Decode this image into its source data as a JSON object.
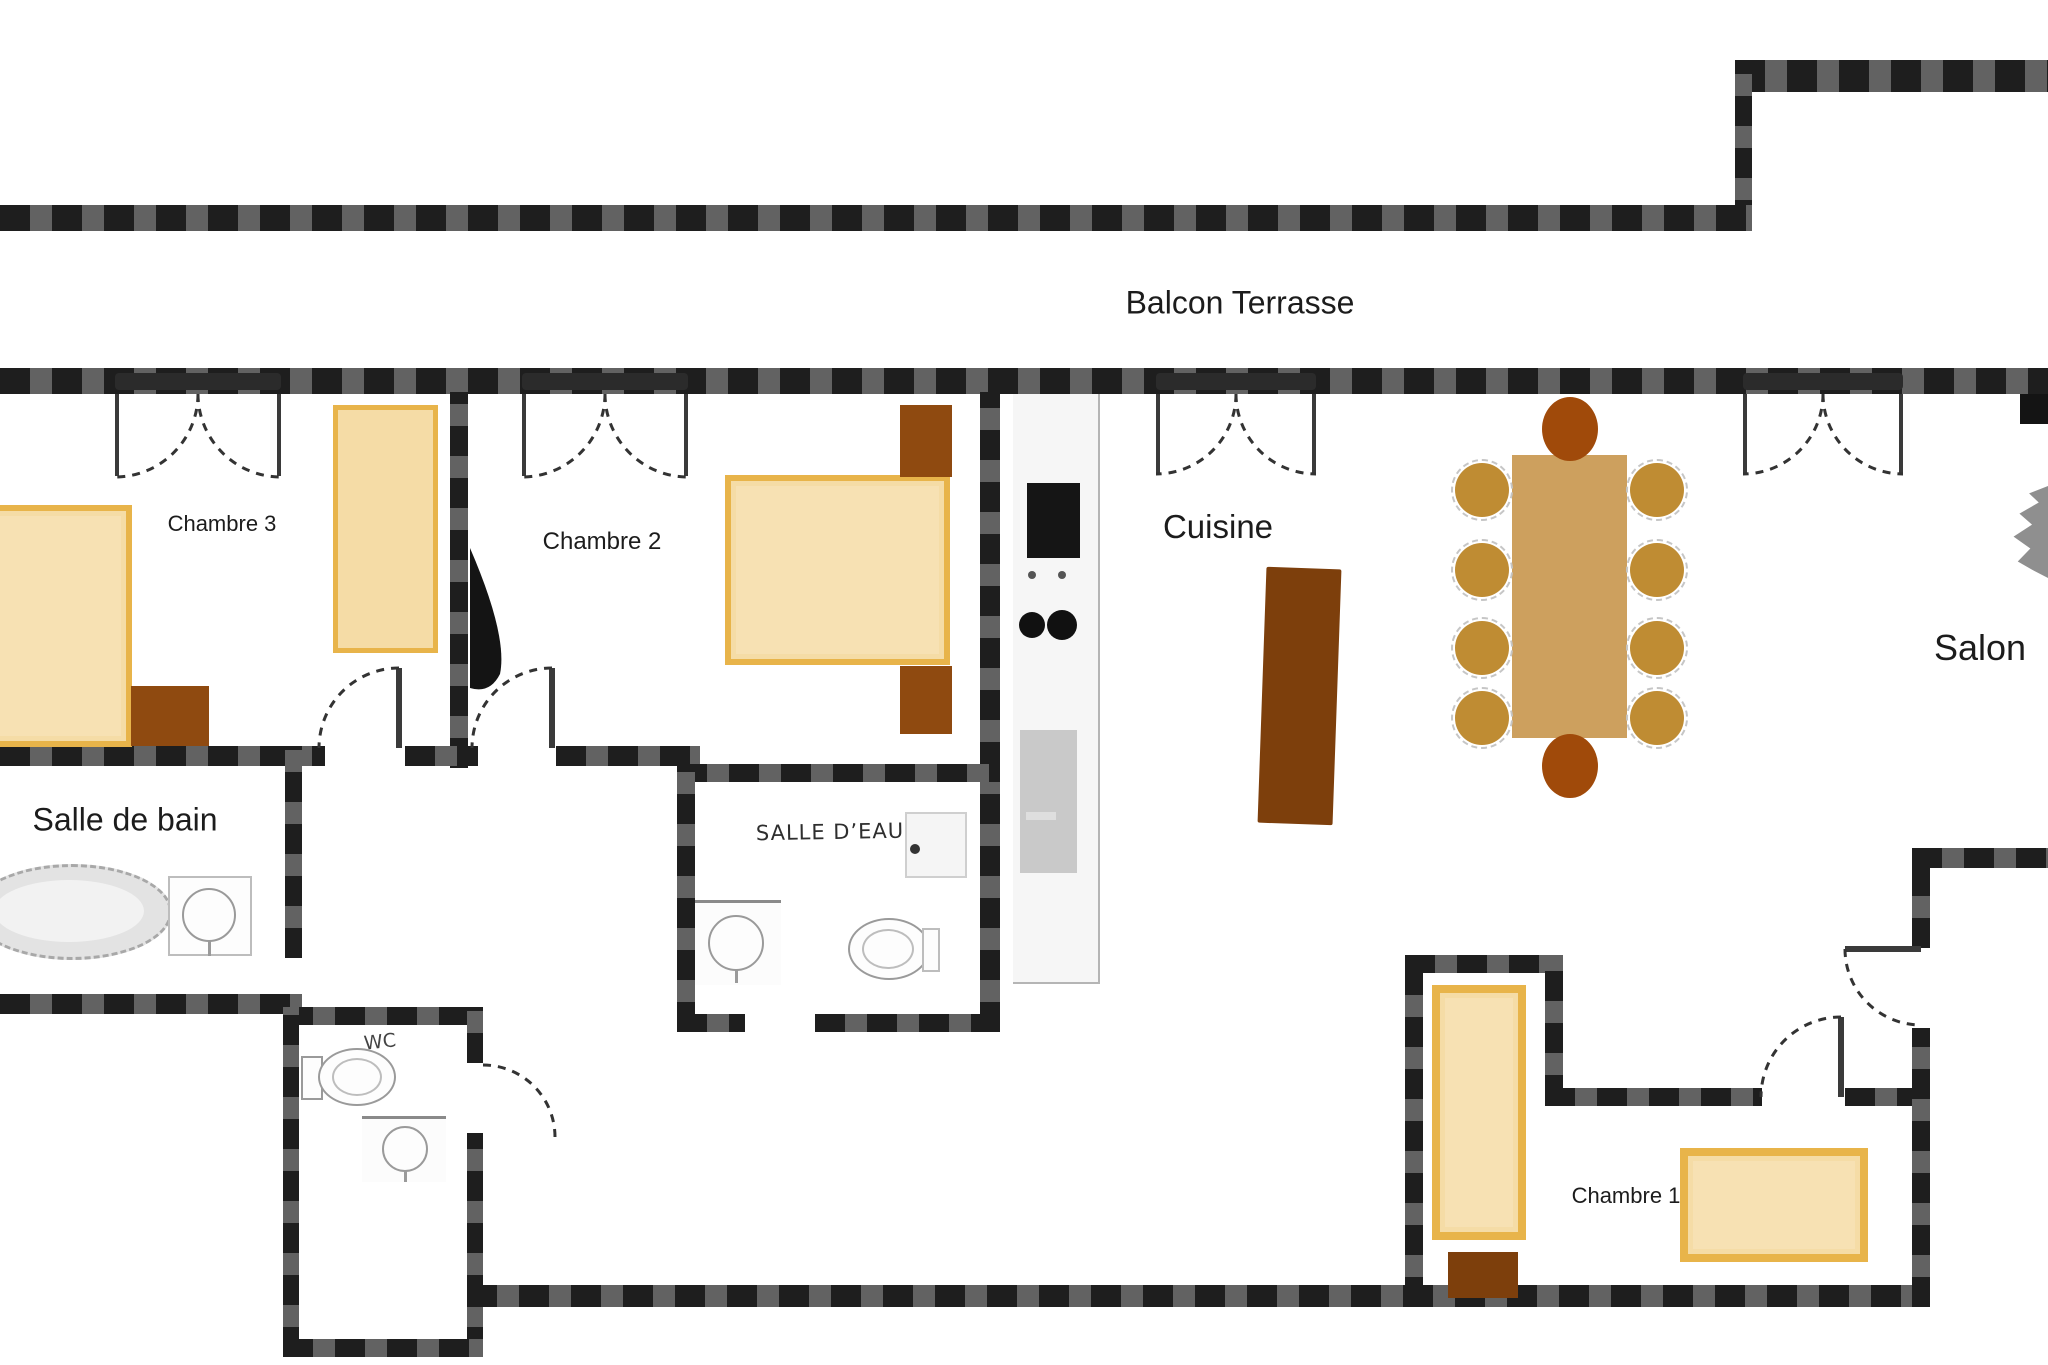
{
  "page_title": "Plan d'appartement - Balcon Terrasse",
  "palette": {
    "wall": "#1e1e1e",
    "text": "#1c1c1c",
    "bed-fill": "#f5dca6",
    "bed-border": "#e8b44a",
    "wood-mid": "#8f4a10",
    "wood-dark": "#7d3f0c",
    "table": "#cda05e",
    "chair": "#bf8c33",
    "chair-dark": "#a04a0a",
    "fixture-line": "#9a9a9a",
    "counter-gray": "#c9c9c9",
    "appliance-black": "#151515",
    "plant-gray": "#8f8f8f"
  },
  "rooms": {
    "balcon": {
      "label": "Balcon Terrasse"
    },
    "chambre3": {
      "label": "Chambre 3"
    },
    "chambre2": {
      "label": "Chambre 2"
    },
    "cuisine": {
      "label": "Cuisine"
    },
    "salon": {
      "label": "Salon"
    },
    "salle_de_bain": {
      "label": "Salle de bain"
    },
    "salle_deau": {
      "label": "SALLE D’EAU"
    },
    "wc": {
      "label": "WC"
    },
    "chambre1": {
      "label": "Chambre 1"
    }
  },
  "symbols": {
    "french-window": "double dashed quarter-arcs under dark lintel",
    "door": "dashed quarter-arc with thin leaf",
    "bed": "tan rectangle with gold border",
    "dining-table": "wood rectangle with 10 chairs",
    "kitchen-island": "dark wood rectangle",
    "bathtub": "gray dashed oval",
    "washbasin": "square with circle",
    "toilet": "oval bowl with tank"
  }
}
